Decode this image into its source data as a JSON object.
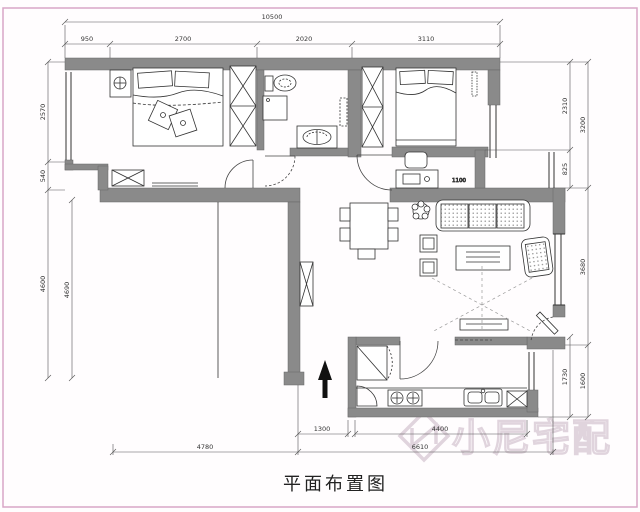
{
  "title": "平面布置图",
  "watermark": {
    "text": "小尼宅配",
    "logo": "cube-n-logo"
  },
  "labels": {
    "desk_dim": "1100"
  },
  "dims": {
    "top_total": "10500",
    "top_segments": [
      "950",
      "2700",
      "2020",
      "3110"
    ],
    "left_outer": [
      "2570",
      "540",
      "4600"
    ],
    "left_inner": "4690",
    "right_inner": [
      "2310",
      "825",
      "1730"
    ],
    "right_outer": [
      "3200",
      "3680",
      "1600"
    ],
    "bottom_upper": [
      "1300",
      "4400"
    ],
    "bottom_lower": [
      "4780",
      "6610"
    ]
  },
  "colors": {
    "wall": "#8a8a8a",
    "line": "#333333",
    "dimension": "#444444",
    "border": "#d9a7c7",
    "watermark": "#d6c7d3"
  }
}
